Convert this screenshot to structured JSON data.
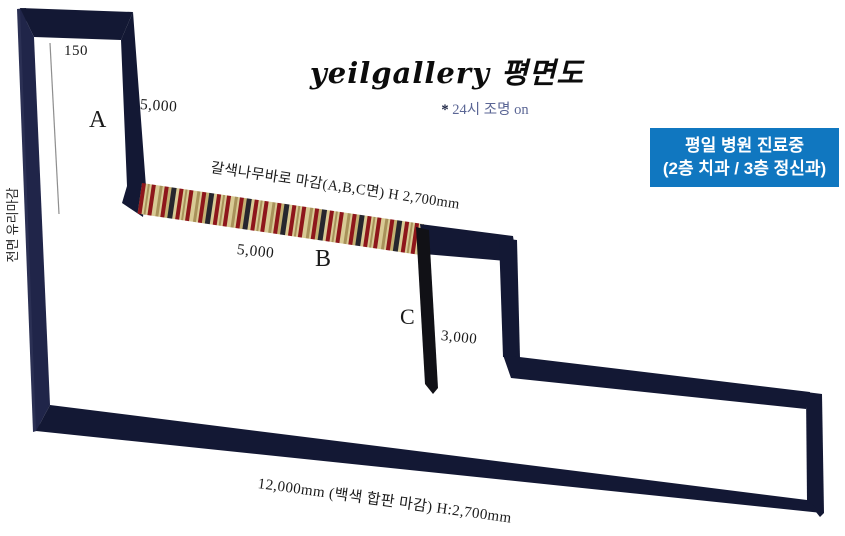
{
  "title": {
    "main": "yeilgallery 평면도",
    "subtitle_mark": "*",
    "subtitle_text": "24시 조명 on"
  },
  "notice_box": {
    "line1": "평일 병원 진료중",
    "line2": "(2층 치과 / 3층 정신과)",
    "bg_color": "#1077c0",
    "text_color": "#ffffff"
  },
  "labels": {
    "dim_150": "150",
    "dim_5000_top": "5,000",
    "dim_5000_mid": "5,000",
    "dim_3000": "3,000",
    "zone_a": "A",
    "zone_b": "B",
    "zone_c": "C",
    "left_wall_note": "전면 유리마감",
    "band_note": "갈색나무바로 마감(A,B,C면) H 2,700mm",
    "bottom_note": "12,000mm (백색 합판 마감) H:2,700mm"
  },
  "colors": {
    "wall": "#131834",
    "wall_light": "#202549",
    "wall_edge": "#2b3054",
    "c_wall": "#111116",
    "band_base": "#d8ca94",
    "band_red": "#8e161b",
    "band_dark": "#26262e",
    "band_brown": "#a8925a",
    "band_tan2": "#c3b072",
    "subtitle_mark": "#1b2342",
    "subtitle_text": "#5b6695",
    "line_gray": "#8e8e8e",
    "text": "#1a1a1a"
  }
}
